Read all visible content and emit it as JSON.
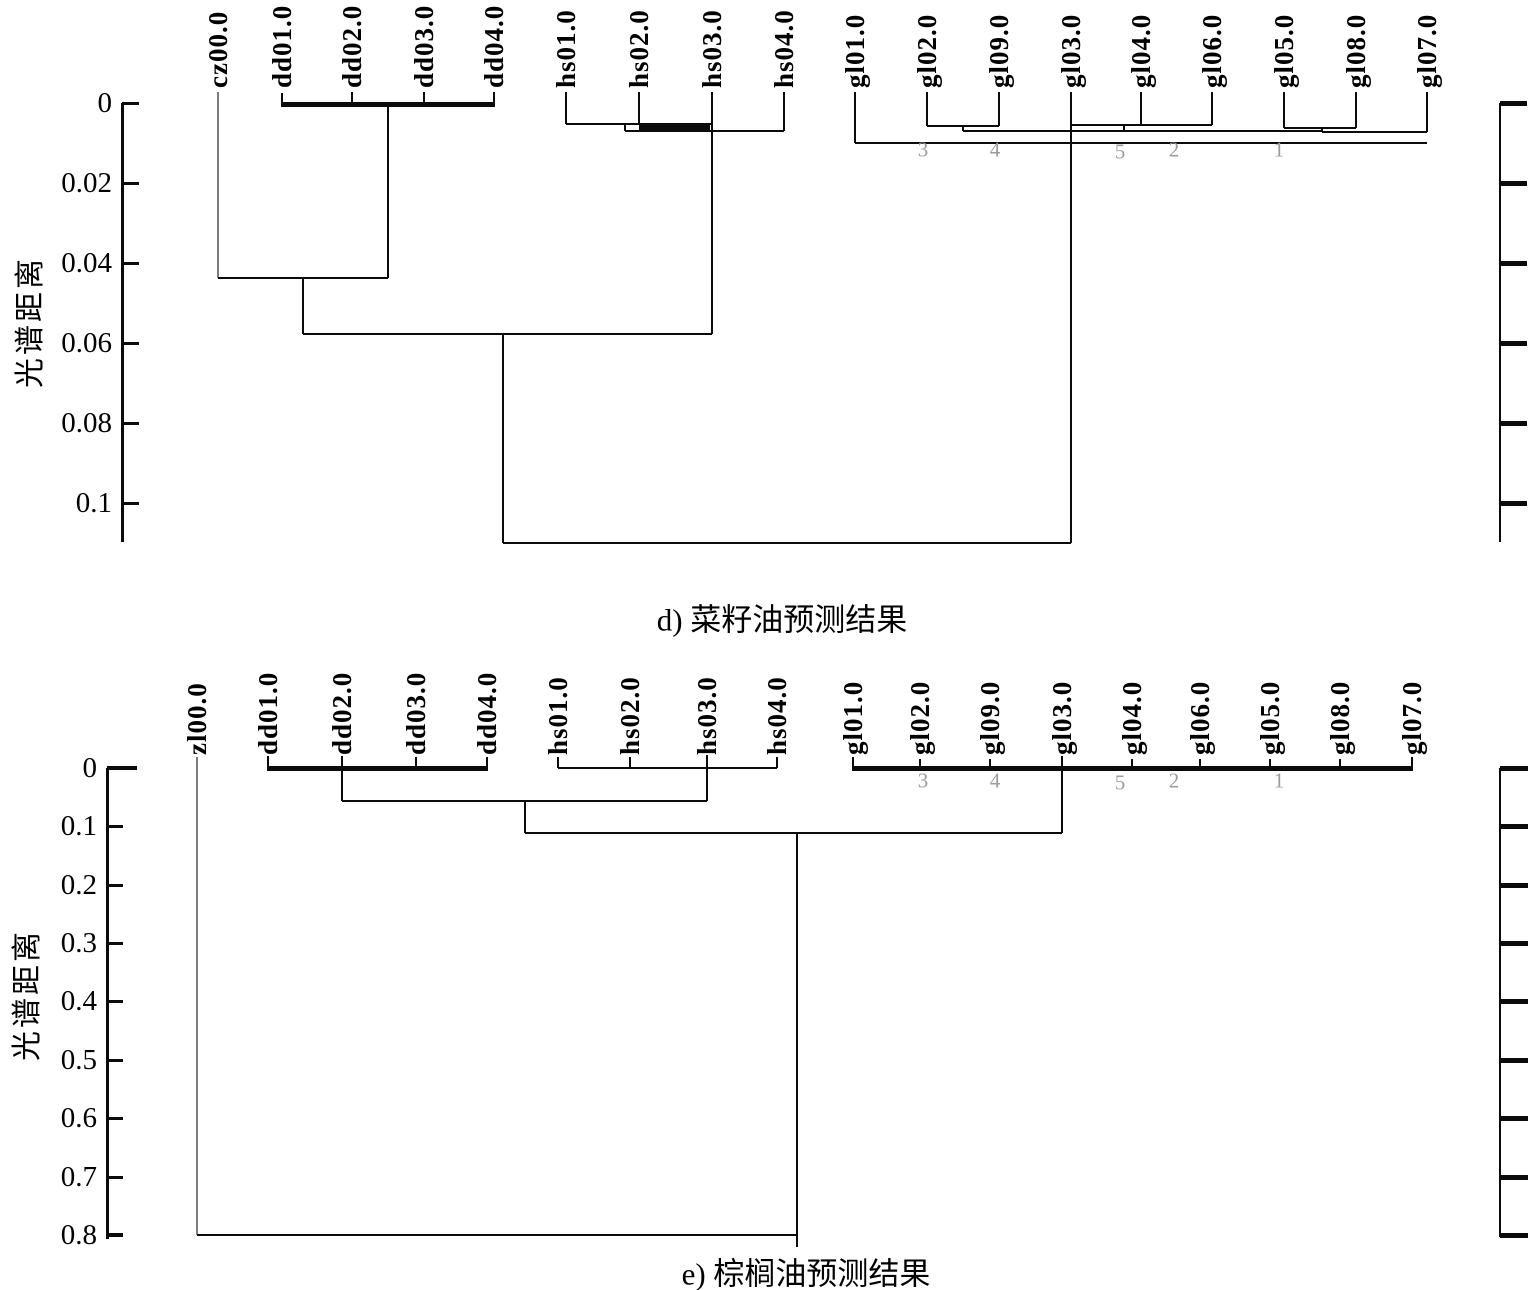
{
  "chart_data": [
    {
      "type": "dendrogram",
      "title": "d) 菜籽油预测结果",
      "ylabel": "光谱距离",
      "ylim": [
        0,
        0.11
      ],
      "grid": false,
      "yticks": [
        "0",
        "0.02",
        "0.04",
        "0.06",
        "0.08",
        "0.1"
      ],
      "ytick_values": [
        0,
        0.02,
        0.04,
        0.06,
        0.08,
        0.1
      ],
      "leaves": [
        "cz00.0",
        "dd01.0",
        "dd02.0",
        "dd03.0",
        "dd04.0",
        "hs01.0",
        "hs02.0",
        "hs03.0",
        "hs04.0",
        "gl01.0",
        "gl02.0",
        "gl09.0",
        "gl03.0",
        "gl04.0",
        "gl06.0",
        "gl05.0",
        "gl08.0",
        "gl07.0"
      ],
      "cluster_numbers": [
        "3",
        "4",
        "5",
        "2",
        "1"
      ],
      "merges": [
        {
          "members": "dd01.0-dd04.0",
          "height": 0.001
        },
        {
          "members": "hs01.0+hs02.0+hs03.0",
          "height": 0.005
        },
        {
          "members": "hs02.0+hs03.0 (thick bar)",
          "height": 0.006
        },
        {
          "members": "(hs01-hs03)+hs04.0",
          "height": 0.007
        },
        {
          "members": "gl02.0+gl09.0",
          "height": 0.006
        },
        {
          "members": "gl03.0+gl04.0+gl06.0",
          "height": 0.0055
        },
        {
          "members": "gl05.0+gl08.0",
          "height": 0.006
        },
        {
          "members": "(gl02,gl09)+(gl03,gl04,gl06)+(gl05,gl08)",
          "height": 0.007
        },
        {
          "members": "gl01.0+...+gl07.0 (all gl)",
          "height": 0.01
        },
        {
          "members": "cz00.0+(dd cluster)",
          "height": 0.044
        },
        {
          "members": "(cz,dd)+(hs cluster)",
          "height": 0.058
        },
        {
          "members": "root: all clusters",
          "height": 0.11
        }
      ],
      "render": {
        "label_bottom": 88,
        "leaf_line_height": 28,
        "leaf_x": [
          218,
          282,
          352,
          424,
          494,
          566,
          639,
          712,
          784,
          855,
          927,
          999,
          1071,
          1141,
          1212,
          1284,
          1356,
          1427
        ],
        "tick_label_right": 112,
        "tick_y": [
          103,
          183,
          263,
          343,
          423,
          503
        ],
        "digits": [
          [
            923,
            150,
            "3"
          ],
          [
            995,
            150,
            "4"
          ],
          [
            1120,
            152,
            "5"
          ],
          [
            1174,
            150,
            "2"
          ],
          [
            1279,
            150,
            "1"
          ]
        ],
        "segments": [
          [
            "v",
            122,
            103,
            542,
            3,
            null,
            "y-axis-line"
          ],
          [
            "h",
            103,
            122,
            139,
            3,
            null,
            "y-axis-tick"
          ],
          [
            "h",
            183,
            122,
            139,
            3,
            null,
            "y-axis-tick"
          ],
          [
            "h",
            263,
            122,
            139,
            3,
            null,
            "y-axis-tick"
          ],
          [
            "h",
            343,
            122,
            139,
            3,
            null,
            "y-axis-tick"
          ],
          [
            "h",
            423,
            122,
            139,
            3,
            null,
            "y-axis-tick"
          ],
          [
            "h",
            503,
            122,
            139,
            3,
            null,
            "y-axis-tick"
          ],
          [
            "v",
            1500,
            103,
            542,
            2,
            null,
            "right-axis-line"
          ],
          [
            "h",
            103,
            1500,
            1527,
            5,
            null,
            "right-axis-tick"
          ],
          [
            "h",
            183,
            1500,
            1527,
            5,
            null,
            "right-axis-tick"
          ],
          [
            "h",
            263,
            1500,
            1527,
            5,
            null,
            "right-axis-tick"
          ],
          [
            "h",
            343,
            1500,
            1527,
            5,
            null,
            "right-axis-tick"
          ],
          [
            "h",
            423,
            1500,
            1527,
            5,
            null,
            "right-axis-tick"
          ],
          [
            "h",
            503,
            1500,
            1527,
            5,
            null,
            "right-axis-tick"
          ],
          [
            "v",
            218,
            92,
            278,
            2,
            "#7d7d7d"
          ],
          [
            "v",
            282,
            93,
            107,
            2
          ],
          [
            "v",
            352,
            92,
            104,
            2
          ],
          [
            "v",
            424,
            92,
            104,
            2
          ],
          [
            "v",
            494,
            92,
            104,
            2
          ],
          [
            "h",
            104,
            281,
            495,
            5
          ],
          [
            "v",
            388,
            106,
            278,
            2
          ],
          [
            "h",
            278,
            218,
            388,
            2
          ],
          [
            "v",
            303,
            278,
            334,
            2
          ],
          [
            "v",
            566,
            92,
            124,
            2
          ],
          [
            "v",
            639,
            92,
            124,
            2
          ],
          [
            "v",
            712,
            92,
            334,
            2
          ],
          [
            "v",
            784,
            92,
            131,
            2
          ],
          [
            "h",
            124,
            566,
            712,
            2
          ],
          [
            "h",
            127,
            639,
            710,
            5
          ],
          [
            "v",
            625,
            124,
            131,
            1.5
          ],
          [
            "h",
            131,
            625,
            784,
            1.5
          ],
          [
            "h",
            334,
            303,
            712,
            2.5
          ],
          [
            "v",
            503,
            334,
            543,
            2.5
          ],
          [
            "v",
            855,
            92,
            143,
            2
          ],
          [
            "v",
            927,
            92,
            126,
            2
          ],
          [
            "v",
            999,
            92,
            126,
            2
          ],
          [
            "h",
            126,
            927,
            999,
            2
          ],
          [
            "v",
            963,
            126,
            131,
            1.5
          ],
          [
            "v",
            1071,
            92,
            125,
            2
          ],
          [
            "v",
            1141,
            92,
            125,
            2
          ],
          [
            "v",
            1212,
            92,
            125,
            2
          ],
          [
            "h",
            125,
            1071,
            1212,
            2
          ],
          [
            "v",
            1124,
            125,
            131,
            1.5
          ],
          [
            "v",
            1284,
            92,
            128,
            2
          ],
          [
            "v",
            1356,
            92,
            128,
            2
          ],
          [
            "h",
            128,
            1284,
            1356,
            2
          ],
          [
            "v",
            1322,
            128,
            132,
            1.5
          ],
          [
            "h",
            131,
            963,
            1322,
            2
          ],
          [
            "h",
            132,
            1322,
            1427,
            1.5
          ],
          [
            "v",
            1427,
            92,
            132,
            2
          ],
          [
            "h",
            143,
            855,
            1427,
            2
          ],
          [
            "v",
            1071,
            125,
            543,
            2
          ],
          [
            "h",
            543,
            503,
            1071,
            2.5
          ]
        ]
      }
    },
    {
      "type": "dendrogram",
      "title": "e) 棕榈油预测结果",
      "ylabel": "光谱距离",
      "ylim": [
        0,
        0.8
      ],
      "grid": false,
      "yticks": [
        "0",
        "0.1",
        "0.2",
        "0.3",
        "0.4",
        "0.5",
        "0.6",
        "0.7",
        "0.8"
      ],
      "ytick_values": [
        0,
        0.1,
        0.2,
        0.3,
        0.4,
        0.5,
        0.6,
        0.7,
        0.8
      ],
      "leaves": [
        "zl00.0",
        "dd01.0",
        "dd02.0",
        "dd03.0",
        "dd04.0",
        "hs01.0",
        "hs02.0",
        "hs03.0",
        "hs04.0",
        "gl01.0",
        "gl02.0",
        "gl09.0",
        "gl03.0",
        "gl04.0",
        "gl06.0",
        "gl05.0",
        "gl08.0",
        "gl07.0"
      ],
      "cluster_numbers": [
        "3",
        "4",
        "5",
        "2",
        "1"
      ],
      "merges": [
        {
          "members": "dd01.0-dd04.0",
          "height": 0.002
        },
        {
          "members": "hs01.0-hs04.0",
          "height": 0.002
        },
        {
          "members": "gl01.0-gl07.0 (9 samples)",
          "height": 0.002
        },
        {
          "members": "(dd)+(hs)",
          "height": 0.057
        },
        {
          "members": "(dd,hs)+(gl)",
          "height": 0.11
        },
        {
          "members": "zl00.0 + all (root)",
          "height": 0.8
        }
      ],
      "render": {
        "label_bottom": 755,
        "leaf_line_height": 28,
        "leaf_x": [
          197,
          268,
          342,
          416,
          487,
          558,
          630,
          707,
          777,
          853,
          920,
          990,
          1062,
          1132,
          1200,
          1270,
          1340,
          1412
        ],
        "tick_label_right": 97,
        "tick_y": [
          768,
          826,
          885,
          943,
          1001,
          1060,
          1118,
          1177,
          1235
        ],
        "digits": [
          [
            923,
            781,
            "3"
          ],
          [
            995,
            781,
            "4"
          ],
          [
            1120,
            783,
            "5"
          ],
          [
            1174,
            781,
            "2"
          ],
          [
            1279,
            781,
            "1"
          ]
        ],
        "segments": [
          [
            "v",
            107,
            768,
            1239,
            3,
            null,
            "y-axis-line"
          ],
          [
            "h",
            768,
            107,
            137,
            4,
            null,
            "y-axis-tick"
          ],
          [
            "h",
            826,
            107,
            123,
            3,
            null,
            "y-axis-tick"
          ],
          [
            "h",
            885,
            107,
            123,
            3,
            null,
            "y-axis-tick"
          ],
          [
            "h",
            943,
            107,
            123,
            3,
            null,
            "y-axis-tick"
          ],
          [
            "h",
            1001,
            107,
            123,
            3,
            null,
            "y-axis-tick"
          ],
          [
            "h",
            1060,
            107,
            123,
            3,
            null,
            "y-axis-tick"
          ],
          [
            "h",
            1118,
            107,
            123,
            3,
            null,
            "y-axis-tick"
          ],
          [
            "h",
            1177,
            107,
            123,
            3,
            null,
            "y-axis-tick"
          ],
          [
            "h",
            1235,
            107,
            123,
            4,
            null,
            "y-axis-tick"
          ],
          [
            "v",
            1500,
            768,
            1237,
            2,
            null,
            "right-axis-line"
          ],
          [
            "h",
            768,
            1500,
            1528,
            5,
            null,
            "right-axis-tick"
          ],
          [
            "h",
            826,
            1500,
            1528,
            5,
            null,
            "right-axis-tick"
          ],
          [
            "h",
            885,
            1500,
            1528,
            5,
            null,
            "right-axis-tick"
          ],
          [
            "h",
            943,
            1500,
            1528,
            5,
            null,
            "right-axis-tick"
          ],
          [
            "h",
            1001,
            1500,
            1528,
            5,
            null,
            "right-axis-tick"
          ],
          [
            "h",
            1060,
            1500,
            1528,
            5,
            null,
            "right-axis-tick"
          ],
          [
            "h",
            1118,
            1500,
            1528,
            5,
            null,
            "right-axis-tick"
          ],
          [
            "h",
            1177,
            1500,
            1528,
            5,
            null,
            "right-axis-tick"
          ],
          [
            "h",
            1235,
            1500,
            1528,
            5,
            null,
            "right-axis-tick"
          ],
          [
            "v",
            197,
            757,
            1235,
            2,
            "#7d7d7d"
          ],
          [
            "v",
            268,
            756,
            770,
            2
          ],
          [
            "v",
            342,
            756,
            768,
            2
          ],
          [
            "v",
            416,
            757,
            768,
            2
          ],
          [
            "v",
            487,
            757,
            768,
            2
          ],
          [
            "h",
            768,
            267,
            488,
            5
          ],
          [
            "v",
            342,
            768,
            801,
            2.5
          ],
          [
            "v",
            558,
            757,
            768,
            2
          ],
          [
            "v",
            630,
            757,
            768,
            2
          ],
          [
            "v",
            707,
            755,
            801,
            2.5
          ],
          [
            "v",
            777,
            757,
            768,
            2
          ],
          [
            "h",
            768,
            558,
            777,
            1.5
          ],
          [
            "h",
            801,
            342,
            707,
            2.5
          ],
          [
            "v",
            525,
            801,
            833,
            2.5
          ],
          [
            "v",
            853,
            757,
            768,
            2
          ],
          [
            "v",
            920,
            759,
            768,
            2
          ],
          [
            "v",
            990,
            759,
            768,
            2
          ],
          [
            "v",
            1062,
            756,
            768,
            2
          ],
          [
            "v",
            1132,
            759,
            768,
            2
          ],
          [
            "v",
            1200,
            759,
            768,
            2
          ],
          [
            "v",
            1270,
            759,
            768,
            2
          ],
          [
            "v",
            1340,
            759,
            768,
            2
          ],
          [
            "v",
            1412,
            757,
            768,
            2
          ],
          [
            "h",
            768,
            852,
            1413,
            5
          ],
          [
            "v",
            1062,
            768,
            833,
            2.5
          ],
          [
            "h",
            833,
            525,
            1062,
            2.5
          ],
          [
            "v",
            797,
            833,
            1247,
            2.5
          ],
          [
            "h",
            1235,
            197,
            797,
            2.5
          ]
        ]
      }
    }
  ]
}
